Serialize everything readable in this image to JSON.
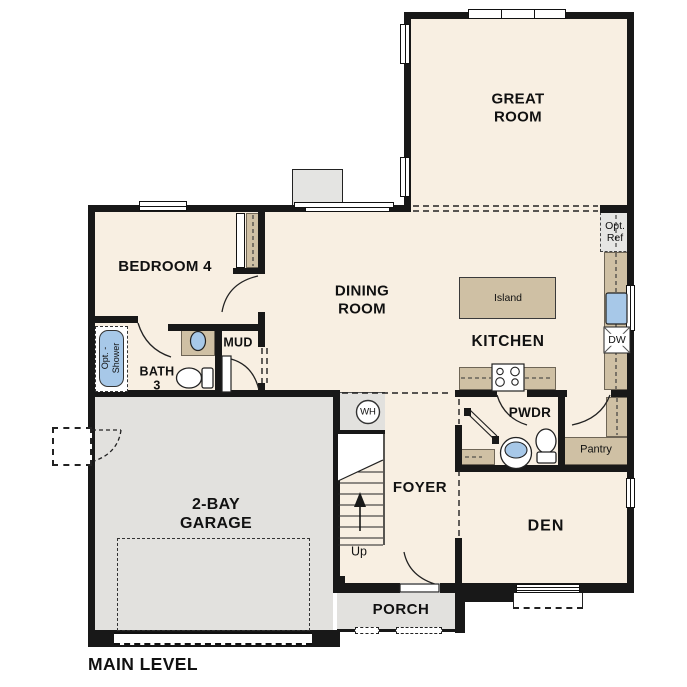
{
  "plan": {
    "title": "MAIN LEVEL",
    "rooms": {
      "great_room": "GREAT\nROOM",
      "dining_room": "DINING\nROOM",
      "bedroom4": "BEDROOM 4",
      "kitchen": "KITCHEN",
      "bath3": "BATH\n3",
      "mud": "MUD",
      "pwdr": "PWDR",
      "pantry": "Pantry",
      "den": "DEN",
      "foyer": "FOYER",
      "garage": "2-BAY\nGARAGE",
      "porch": "PORCH"
    },
    "fixtures": {
      "island": "Island",
      "opt_ref": "Opt.\nRef",
      "dw": "DW",
      "wh": "WH",
      "up": "Up",
      "opt_shower": "Opt. -\nShower"
    },
    "icons": [
      "stove-icon",
      "dishwasher-icon",
      "kitchen-sink-icon",
      "pedestal-sink-icon",
      "vanity-sink-icon",
      "toilet-icon",
      "tub-shower-icon",
      "water-heater-icon",
      "stairs-up-arrow-icon",
      "door-swing-arc",
      "window-glyph"
    ],
    "colors": {
      "floor": "#f8efe2",
      "garage_floor": "#e2e1de",
      "counter_tan": "#cfc0a4",
      "fixture_blue": "#a7c8e8",
      "wall": "#181818"
    }
  }
}
